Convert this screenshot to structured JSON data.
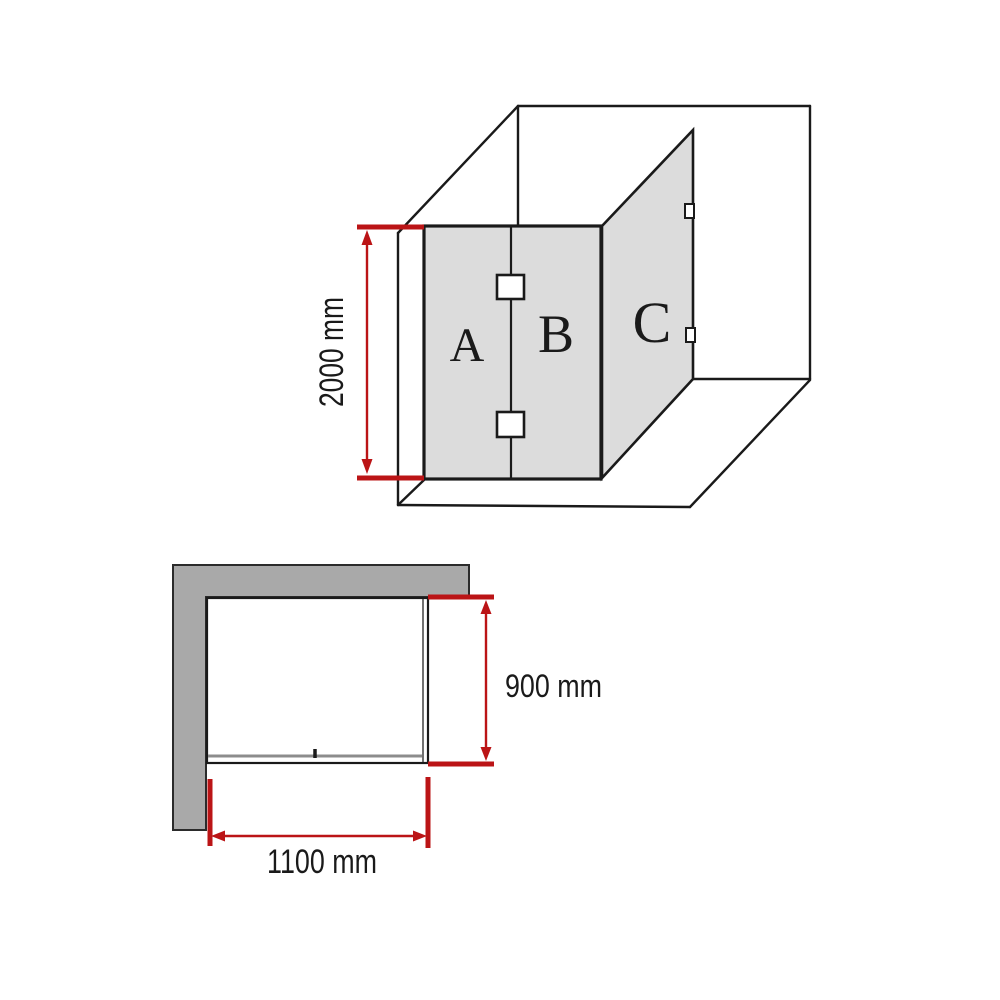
{
  "page": {
    "background": "#ffffff",
    "description": "Shower screen dimension diagram with a 3D perspective view and a top-down plan view"
  },
  "colors": {
    "dimension_red": "#bb1416",
    "glass_panel_gray": "#dcdcdc",
    "wall_gray": "#a9a9a9",
    "outline_black": "#1a1a1a"
  },
  "perspective_view": {
    "description": "Corner room view showing glass panels A and B at the front and return panel C on the side, with two hinges between A and B and two wall brackets on C",
    "panel_a_label": "A",
    "panel_b_label": "B",
    "panel_c_label": "C",
    "height_dimension": "2000 mm"
  },
  "plan_view": {
    "description": "Plan view of shower enclosure against an L-shaped wall with glass panel lines and a hinge mark",
    "depth_dimension": "900 mm",
    "width_dimension": "1100 mm"
  }
}
